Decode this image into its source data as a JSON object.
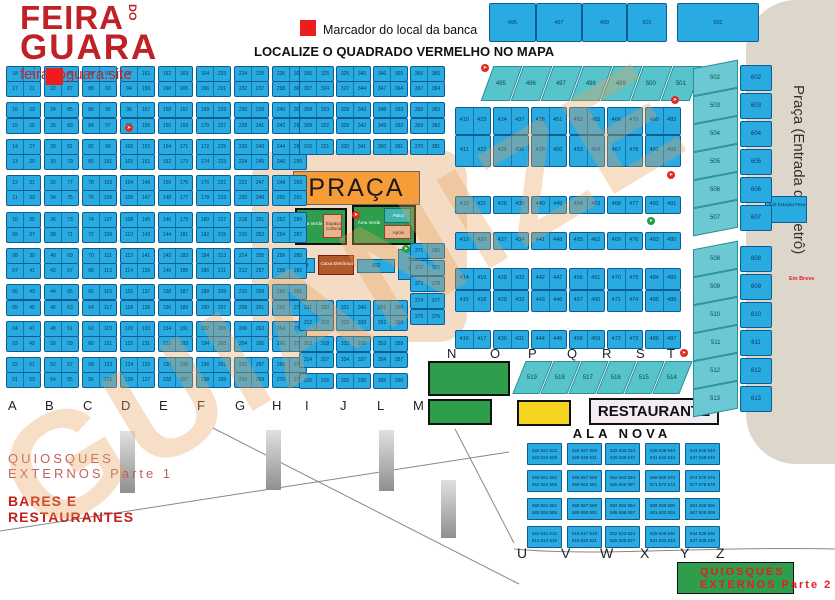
{
  "header": {
    "logo_line1": "FEIRA",
    "logo_do": "DO",
    "logo_line2": "GUARA",
    "site": "feiradoguara.site",
    "legend_label": "Marcador do local da banca",
    "title": "LOCALIZE O QUADRADO VERMELHO NO MAPA",
    "top_boxes": [
      "495",
      "497",
      "499",
      "501",
      "502"
    ]
  },
  "watermark_text": "GUIANIZE",
  "metro": {
    "label": "Praça (Entrada do Metrô)",
    "em_breve": "Em Breve",
    "substation": "Sub Estação Feira",
    "slanted_column": [
      "502",
      "503",
      "504",
      "505",
      "506",
      "507",
      "508",
      "509",
      "510",
      "511",
      "512",
      "513"
    ],
    "straight_column": [
      "602",
      "603",
      "604",
      "605",
      "606",
      "607",
      "608",
      "609",
      "610",
      "611",
      "612",
      "613"
    ]
  },
  "strips": {
    "top_strip": [
      "495",
      "496",
      "497",
      "498",
      "499",
      "500",
      "501"
    ],
    "south_strip": [
      "519",
      "518",
      "517",
      "516",
      "515",
      "514"
    ]
  },
  "grid": {
    "left_columns": [
      {
        "letter": "A",
        "pairs": [
          [
            "18",
            "19"
          ],
          [
            "17",
            "21"
          ],
          [
            "16",
            "23"
          ],
          [
            "15",
            "25"
          ],
          [
            "14",
            "27"
          ],
          [
            "13",
            "29"
          ],
          [
            "12",
            "31"
          ],
          [
            "11",
            "33"
          ],
          [
            "10",
            "35"
          ],
          [
            "09",
            "37"
          ],
          [
            "08",
            "39"
          ],
          [
            "07",
            "41"
          ],
          [
            "06",
            "43"
          ],
          [
            "05",
            "45"
          ],
          [
            "04",
            "47"
          ],
          [
            "03",
            "49"
          ],
          [
            "02",
            "51"
          ],
          [
            "01",
            "53"
          ]
        ]
      },
      {
        "letter": "B",
        "pairs": [
          [
            "20",
            "89"
          ],
          [
            "22",
            "87"
          ],
          [
            "24",
            "85"
          ],
          [
            "26",
            "83"
          ],
          [
            "28",
            "81"
          ],
          [
            "30",
            "79"
          ],
          [
            "32",
            "77"
          ],
          [
            "34",
            "75"
          ],
          [
            "36",
            "73"
          ],
          [
            "38",
            "71"
          ],
          [
            "40",
            "69"
          ],
          [
            "42",
            "67"
          ],
          [
            "44",
            "65"
          ],
          [
            "46",
            "63"
          ],
          [
            "48",
            "61"
          ],
          [
            "50",
            "59"
          ],
          [
            "52",
            "57"
          ],
          [
            "54",
            "55"
          ]
        ]
      },
      {
        "letter": "C",
        "pairs": [
          [
            "90",
            "91"
          ],
          [
            "88",
            "93"
          ],
          [
            "86",
            "95"
          ],
          [
            "84",
            "97"
          ],
          [
            "82",
            "99"
          ],
          [
            "80",
            "101"
          ],
          [
            "78",
            "103"
          ],
          [
            "76",
            "105"
          ],
          [
            "74",
            "107"
          ],
          [
            "72",
            "109"
          ],
          [
            "70",
            "111"
          ],
          [
            "68",
            "113"
          ],
          [
            "66",
            "115"
          ],
          [
            "64",
            "117"
          ],
          [
            "62",
            "119"
          ],
          [
            "60",
            "121"
          ],
          [
            "58",
            "123"
          ],
          [
            "56",
            "125"
          ]
        ]
      },
      {
        "letter": "D",
        "pairs": [
          [
            "92",
            "161"
          ],
          [
            "94",
            "159"
          ],
          [
            "96",
            "157"
          ],
          [
            "98",
            "155"
          ],
          [
            "100",
            "153"
          ],
          [
            "102",
            "151"
          ],
          [
            "104",
            "149"
          ],
          [
            "106",
            "147"
          ],
          [
            "108",
            "145"
          ],
          [
            "110",
            "143"
          ],
          [
            "112",
            "141"
          ],
          [
            "114",
            "139"
          ],
          [
            "116",
            "137"
          ],
          [
            "118",
            "135"
          ],
          [
            "120",
            "133"
          ],
          [
            "122",
            "131"
          ],
          [
            "124",
            "129"
          ],
          [
            "126",
            "127"
          ]
        ]
      },
      {
        "letter": "E",
        "pairs": [
          [
            "162",
            "163"
          ],
          [
            "160",
            "165"
          ],
          [
            "158",
            "167"
          ],
          [
            "156",
            "169"
          ],
          [
            "154",
            "171"
          ],
          [
            "152",
            "173"
          ],
          [
            "150",
            "175"
          ],
          [
            "148",
            "177"
          ],
          [
            "146",
            "179"
          ],
          [
            "144",
            "181"
          ],
          [
            "142",
            "183"
          ],
          [
            "140",
            "185"
          ],
          [
            "138",
            "187"
          ],
          [
            "136",
            "189"
          ],
          [
            "134",
            "191"
          ],
          [
            "132",
            "193"
          ],
          [
            "130",
            "195"
          ],
          [
            "128",
            "197"
          ]
        ]
      },
      {
        "letter": "F",
        "pairs": [
          [
            "164",
            "233"
          ],
          [
            "166",
            "231"
          ],
          [
            "168",
            "229"
          ],
          [
            "170",
            "227"
          ],
          [
            "172",
            "225"
          ],
          [
            "174",
            "223"
          ],
          [
            "176",
            "221"
          ],
          [
            "178",
            "219"
          ],
          [
            "180",
            "217"
          ],
          [
            "182",
            "215"
          ],
          [
            "184",
            "213"
          ],
          [
            "186",
            "211"
          ],
          [
            "188",
            "209"
          ],
          [
            "190",
            "207"
          ],
          [
            "192",
            "205"
          ],
          [
            "194",
            "203"
          ],
          [
            "196",
            "201"
          ],
          [
            "198",
            "199"
          ]
        ]
      },
      {
        "letter": "G",
        "pairs": [
          [
            "234",
            "235"
          ],
          [
            "232",
            "237"
          ],
          [
            "230",
            "239"
          ],
          [
            "228",
            "241"
          ],
          [
            "226",
            "243"
          ],
          [
            "224",
            "245"
          ],
          [
            "222",
            "247"
          ],
          [
            "220",
            "249"
          ],
          [
            "218",
            "251"
          ],
          [
            "216",
            "253"
          ],
          [
            "214",
            "255"
          ],
          [
            "212",
            "257"
          ],
          [
            "210",
            "259"
          ],
          [
            "208",
            "261"
          ],
          [
            "206",
            "263"
          ],
          [
            "204",
            "265"
          ],
          [
            "202",
            "267"
          ],
          [
            "200",
            "269"
          ]
        ]
      },
      {
        "letter": "H",
        "pairs": [
          [
            "236",
            "305"
          ],
          [
            "238",
            "303"
          ],
          [
            "240",
            "301"
          ],
          [
            "242",
            "299"
          ],
          [
            "244",
            "297"
          ],
          [
            "246",
            "295"
          ],
          [
            "248",
            "293"
          ],
          [
            "250",
            "291"
          ],
          [
            "252",
            "289"
          ],
          [
            "254",
            "287"
          ],
          [
            "256",
            "285"
          ],
          [
            "258",
            "283"
          ],
          [
            "260",
            "281"
          ],
          [
            "262",
            "279"
          ],
          [
            "264",
            "277"
          ],
          [
            "266",
            "275"
          ],
          [
            "268",
            "273"
          ],
          [
            "270",
            "271"
          ]
        ]
      }
    ],
    "mid_columns": [
      {
        "letter": "I",
        "pairs": [
          [
            "306",
            "325"
          ],
          [
            "307",
            "324"
          ],
          [
            "308",
            "323"
          ],
          [
            "309",
            "322"
          ],
          [
            "310",
            "321"
          ],
          [
            "311",
            "320"
          ],
          [
            "312",
            "319"
          ],
          [
            "313",
            "318"
          ],
          [
            "314",
            "317"
          ],
          [
            "315",
            "316"
          ]
        ]
      },
      {
        "letter": "J",
        "pairs": [
          [
            "326",
            "345"
          ],
          [
            "327",
            "344"
          ],
          [
            "328",
            "343"
          ],
          [
            "329",
            "342"
          ],
          [
            "330",
            "341"
          ],
          [
            "331",
            "340"
          ],
          [
            "332",
            "339"
          ],
          [
            "333",
            "338"
          ],
          [
            "334",
            "337"
          ],
          [
            "335",
            "336"
          ]
        ]
      },
      {
        "letter": "L",
        "pairs": [
          [
            "346",
            "365"
          ],
          [
            "347",
            "364"
          ],
          [
            "348",
            "363"
          ],
          [
            "349",
            "362"
          ],
          [
            "350",
            "361"
          ],
          [
            "351",
            "360"
          ],
          [
            "352",
            "359"
          ],
          [
            "353",
            "358"
          ],
          [
            "354",
            "357"
          ],
          [
            "355",
            "356"
          ]
        ]
      },
      {
        "letter": "M",
        "pairs": [
          [
            "366",
            "385"
          ],
          [
            "367",
            "384"
          ],
          [
            "368",
            "383"
          ],
          [
            "369",
            "382"
          ],
          [
            "370",
            "381"
          ],
          [
            "371",
            "380"
          ],
          [
            "372",
            "379"
          ],
          [
            "373",
            "378"
          ],
          [
            "374",
            "377"
          ],
          [
            "375",
            "376"
          ]
        ]
      }
    ],
    "right_columns": [
      {
        "letter": "N",
        "pairs": [
          [
            "410",
            "423"
          ],
          [
            "411",
            "422"
          ],
          [
            "412",
            "421"
          ],
          [
            "413",
            "420"
          ],
          [
            "414",
            "419"
          ],
          [
            "415",
            "418"
          ],
          [
            "416",
            "417"
          ]
        ]
      },
      {
        "letter": "O",
        "pairs": [
          [
            "424",
            "437"
          ],
          [
            "425",
            "436"
          ],
          [
            "426",
            "435"
          ],
          [
            "427",
            "434"
          ],
          [
            "428",
            "433"
          ],
          [
            "429",
            "432"
          ],
          [
            "430",
            "431"
          ]
        ]
      },
      {
        "letter": "P",
        "pairs": [
          [
            "438",
            "451"
          ],
          [
            "439",
            "450"
          ],
          [
            "440",
            "449"
          ],
          [
            "441",
            "448"
          ],
          [
            "442",
            "447"
          ],
          [
            "443",
            "446"
          ],
          [
            "444",
            "445"
          ]
        ]
      },
      {
        "letter": "Q",
        "pairs": [
          [
            "452",
            "465"
          ],
          [
            "453",
            "464"
          ],
          [
            "454",
            "463"
          ],
          [
            "455",
            "462"
          ],
          [
            "456",
            "461"
          ],
          [
            "457",
            "460"
          ],
          [
            "458",
            "459"
          ]
        ]
      },
      {
        "letter": "R",
        "pairs": [
          [
            "466",
            "479"
          ],
          [
            "467",
            "478"
          ],
          [
            "468",
            "477"
          ],
          [
            "469",
            "476"
          ],
          [
            "470",
            "475"
          ],
          [
            "471",
            "474"
          ],
          [
            "472",
            "473"
          ]
        ]
      },
      {
        "letter": "S",
        "pairs": [
          [
            "480",
            "493"
          ],
          [
            "481",
            "492"
          ],
          [
            "482",
            "491"
          ],
          [
            "483",
            "490"
          ],
          [
            "484",
            "489"
          ],
          [
            "485",
            "488"
          ],
          [
            "486",
            "487"
          ]
        ]
      }
    ]
  },
  "letters": {
    "main_row": [
      "A",
      "B",
      "C",
      "D",
      "E",
      "F",
      "G",
      "H",
      "I",
      "J",
      "L",
      "M"
    ],
    "north_row": [
      "N",
      "O",
      "P",
      "Q",
      "R",
      "S",
      "T"
    ],
    "south_row": [
      "U",
      "V",
      "W",
      "X",
      "Y",
      "Z"
    ]
  },
  "praca": {
    "title": "PRAÇA",
    "green_left_label": "Área Verde",
    "green_left_tag": "Espaço Cultural",
    "green_right_label": "Área Verde",
    "green_right_tag_top": "Palco",
    "green_right_tag_bottom": "Apoio",
    "booth_383": "383",
    "caixa": "Caixa Eletrônico",
    "booth_362": "362",
    "booth_524": "524",
    "booth_525": "525"
  },
  "south_area": {
    "restaurante": "RESTAURANTE",
    "ala_nova": "ALA NOVA",
    "quiosques1_line1": "QUIOSQUES",
    "quiosques1_line2": "EXTERNOS Parte 1",
    "bares_line1": "BARES E",
    "bares_line2": "RESTAURANTES",
    "quiosques2_line1": "QUIOSQUES",
    "quiosques2_line2": "EXTERNOS Parte 2"
  },
  "ala_nova_boxes": [
    [
      "520 521 522",
      "523 524 525"
    ],
    [
      "526 527 528",
      "529 530 531"
    ],
    [
      "532 533 534",
      "535 536 537"
    ],
    [
      "538 539 540",
      "541 542 543"
    ],
    [
      "544 545 546",
      "547 548 549"
    ],
    [
      "550 551 552",
      "553 554 555"
    ],
    [
      "556 557 558",
      "559 560 561"
    ],
    [
      "562 563 564",
      "565 566 567"
    ],
    [
      "568 569 570",
      "571 572 573"
    ],
    [
      "574 575 576",
      "577 578 579"
    ],
    [
      "580 581 582",
      "583 584 585"
    ],
    [
      "586 587 588",
      "589 590 591"
    ],
    [
      "592 593 594",
      "595 596 597"
    ],
    [
      "598 599 600",
      "601 602 603"
    ],
    [
      "604 605 606",
      "607 608 609"
    ],
    [
      "610 611 612",
      "613 614 615"
    ],
    [
      "616 617 618",
      "619 620 621"
    ],
    [
      "622 623 624",
      "625 626 627"
    ],
    [
      "628 629 630",
      "631 632 633"
    ],
    [
      "634 635 636",
      "637 638 639"
    ]
  ],
  "markers": [
    {
      "type": "red",
      "x": 125,
      "y": 124
    },
    {
      "type": "red",
      "x": 481,
      "y": 64
    },
    {
      "type": "red",
      "x": 671,
      "y": 96
    },
    {
      "type": "red",
      "x": 667,
      "y": 171
    },
    {
      "type": "red",
      "x": 680,
      "y": 349
    },
    {
      "type": "red",
      "x": 352,
      "y": 211
    },
    {
      "type": "green",
      "x": 402,
      "y": 245
    },
    {
      "type": "green",
      "x": 647,
      "y": 217
    }
  ],
  "colors": {
    "booth_blue": "#29abe2",
    "strip_teal": "#57c4cb",
    "praca_orange": "#f89c38",
    "green": "#2f9e4c",
    "yellow": "#f6d41f",
    "brand_red": "#bf2126",
    "marker_red": "#e02b20",
    "beige": "#ddd6ca"
  }
}
